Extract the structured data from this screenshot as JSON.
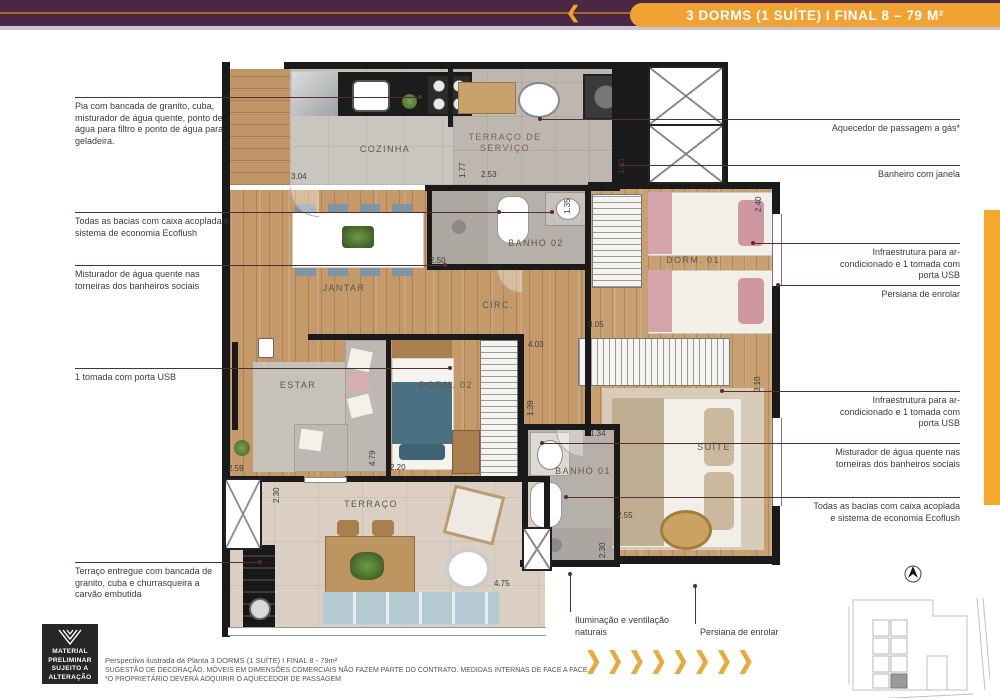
{
  "header": {
    "title": "3 DORMS (1 SUÍTE) I FINAL 8 – 79 M²",
    "back_icon": "❮"
  },
  "colors": {
    "accent_gold": "#F0A232",
    "bar_purple": "#482843",
    "callout_line": "#5A2B33"
  },
  "plan": {
    "rooms": [
      "COZINHA",
      "TERRAÇO DE SERVIÇO",
      "BANHO 02",
      "DORM. 01",
      "JANTAR",
      "CIRC.",
      "ESTAR",
      "DORM. 02",
      "BANHO 01",
      "SUÍTE",
      "TERRAÇO"
    ],
    "dims": [
      "3.04",
      "1.77",
      "2.53",
      "1.83",
      "1.35",
      "2.50",
      "2.40",
      "3.05",
      "4.03",
      "1.39",
      "2.59",
      "4.79",
      "2.20",
      "1.34",
      "3.10",
      "2.55",
      "2.30",
      "4.75",
      "2.30"
    ]
  },
  "callouts": {
    "left": [
      "Pia com bancada de granito, cuba, misturador de água quente, ponto de água para filtro e ponto de água para geladeira.",
      "Todas as bacias com caixa acoplada e sistema de economia Ecoflush",
      "Misturador de água quente nas torneiras dos banheiros sociais",
      "1 tomada com porta USB",
      "Terraço entregue com bancada de granito, cuba e churrasqueira a carvão embutida"
    ],
    "right": [
      "Aquecedor de passagem a gás*",
      "Banheiro com janela",
      "Infraestrutura para ar-condicionado e 1 tomada com porta USB",
      "Persiana de enrolar",
      "Infraestrutura para ar-condicionado e 1 tomada com porta USB",
      "Misturador de água quente nas torneiras dos banheiros sociais",
      "Todas as bacias com caixa acoplada e sistema de economia Ecoflush"
    ],
    "bottom": [
      "Iluminação e ventilação naturais",
      "Persiana de enrolar"
    ]
  },
  "badge": {
    "lines": [
      "MATERIAL",
      "PRELIMINAR",
      "SUJEITO A",
      "ALTERAÇÃO"
    ]
  },
  "footer": {
    "line1": "Perspectiva ilustrada da Planta 3 DORMS (1 SUÍTE) I FINAL 8 - 79m²",
    "line2": "SUGESTÃO DE DECORAÇÃO. MÓVEIS EM DIMENSÕES COMERCIAIS NÃO FAZEM PARTE DO CONTRATO. MEDIDAS INTERNAS DE FACE A FACE.",
    "line3": "*O PROPRIETÁRIO DEVERÁ ADQUIRIR O AQUECEDOR DE PASSAGEM"
  },
  "pagination_chevrons": "❯❯❯❯❯❯❯❯"
}
